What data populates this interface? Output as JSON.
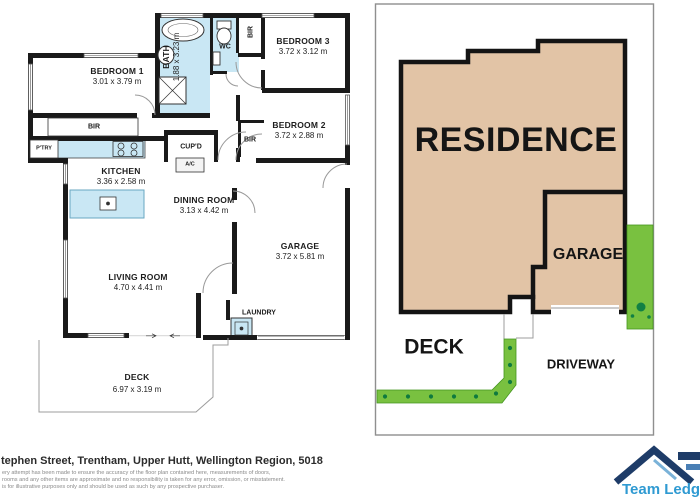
{
  "floorplan": {
    "rooms": {
      "bedroom1": {
        "name": "BEDROOM 1",
        "dims": "3.01 x 3.79 m"
      },
      "bedroom2": {
        "name": "BEDROOM 2",
        "dims": "3.72 x 2.88 m"
      },
      "bedroom3": {
        "name": "BEDROOM 3",
        "dims": "3.72 x 3.12 m"
      },
      "bath": {
        "name": "BATH",
        "dims": "1.88 x 3.23 m"
      },
      "kitchen": {
        "name": "KITCHEN",
        "dims": "3.36 x 2.58 m"
      },
      "dining": {
        "name": "DINING ROOM",
        "dims": "3.13 x 4.42 m"
      },
      "garage": {
        "name": "GARAGE",
        "dims": "3.72 x 5.81 m"
      },
      "living": {
        "name": "LIVING ROOM",
        "dims": "4.70 x 4.41 m"
      },
      "deck": {
        "name": "DECK",
        "dims": "6.97 x 3.19 m"
      }
    },
    "labels": {
      "wc": "WC",
      "bir": "BIR",
      "pantry": "P'TRY",
      "cupboard": "CUP'D",
      "ac": "A/C",
      "laundry": "LAUNDRY"
    }
  },
  "siteplan": {
    "residence": "RESIDENCE",
    "garage": "GARAGE",
    "deck": "DECK",
    "driveway": "DRIVEWAY"
  },
  "footer": {
    "address": "tephen Street, Trentham, Upper Hutt, Wellington Region, 5018",
    "disclaimer": [
      "ery attempt has been made to ensure the accuracy of the floor plan contained here, measurements of doors,",
      "rooms and any other items are approximate and no responsibility is taken for any error, omission, or misstatement.",
      "is for illustrative purposes only and should be used as such by any prospective purchaser."
    ]
  },
  "logo": {
    "text": "Team Ledg"
  },
  "colors": {
    "wet_area_blue": "#c9e7f4",
    "residence_tan": "#e2c4a6",
    "garden_green": "#79c140",
    "garden_dot_green": "#128044",
    "wall_black": "#1a1a1a",
    "logo_navy": "#1e3c68",
    "logo_blue": "#2f9ad2"
  }
}
